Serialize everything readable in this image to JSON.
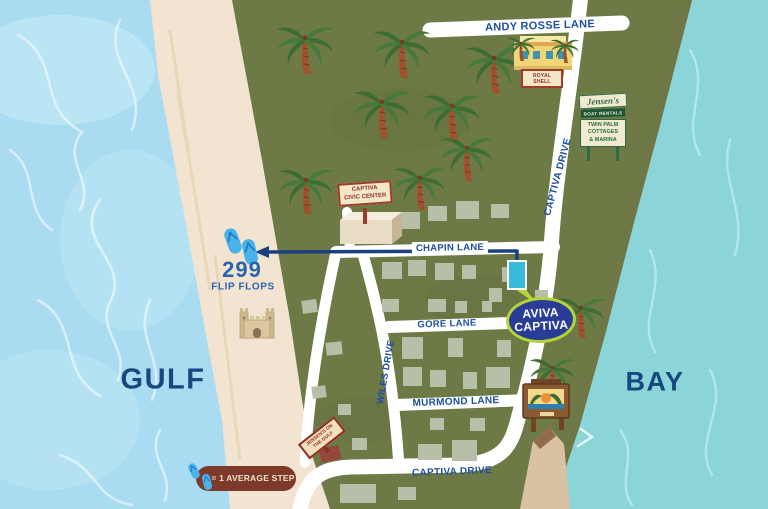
{
  "map": {
    "region_labels": {
      "gulf": "GULF",
      "bay": "BAY"
    },
    "roads": {
      "andy_rosse_lane": "ANDY ROSSE LANE",
      "captiva_drive_upper": "CAPTIVA DRIVE",
      "chapin_lane": "CHAPIN LANE",
      "gore_lane": "GORE LANE",
      "wiles_drive": "WILES DRIVE",
      "murmond_lane": "MURMOND LANE",
      "captiva_drive_lower": "CAPTIVA DRIVE"
    },
    "landmarks": {
      "royal_shell_sign": {
        "label": "ROYAL SHELL"
      },
      "jensens_marina": {
        "title": "Jensen's",
        "banner": "BOAT RENTALS",
        "line1": "TWIN PALM",
        "line2": "COTTAGES",
        "line3": "& MARINA"
      },
      "civic_center": {
        "line1": "CAPTIVA",
        "line2": "CIVIC CENTER"
      },
      "flip_flops": {
        "number": "299",
        "label": "FLIP FLOPS"
      },
      "aviva_captiva": {
        "line1": "AVIVA",
        "line2": "CAPTIVA"
      },
      "jensens_on_the_gulf": {
        "line1": "JENSEN'S ON",
        "line2": "THE GULF"
      }
    },
    "legend": {
      "text": "= 1 AVERAGE STEP"
    },
    "colors": {
      "gulf_water": "#a9dcf0",
      "bay_water": "#8bd5d8",
      "sand": "#f2e4d0",
      "land": "#6d7a46",
      "road": "#ffffff",
      "route_blue": "#1b4080",
      "label_blue": "#1d4f9e",
      "aviva_navy": "#2a3d96",
      "aviva_lime": "#b5d43a",
      "legend_bg": "#7d3a2a",
      "flip_flop_blue": "#49b2e9"
    }
  }
}
